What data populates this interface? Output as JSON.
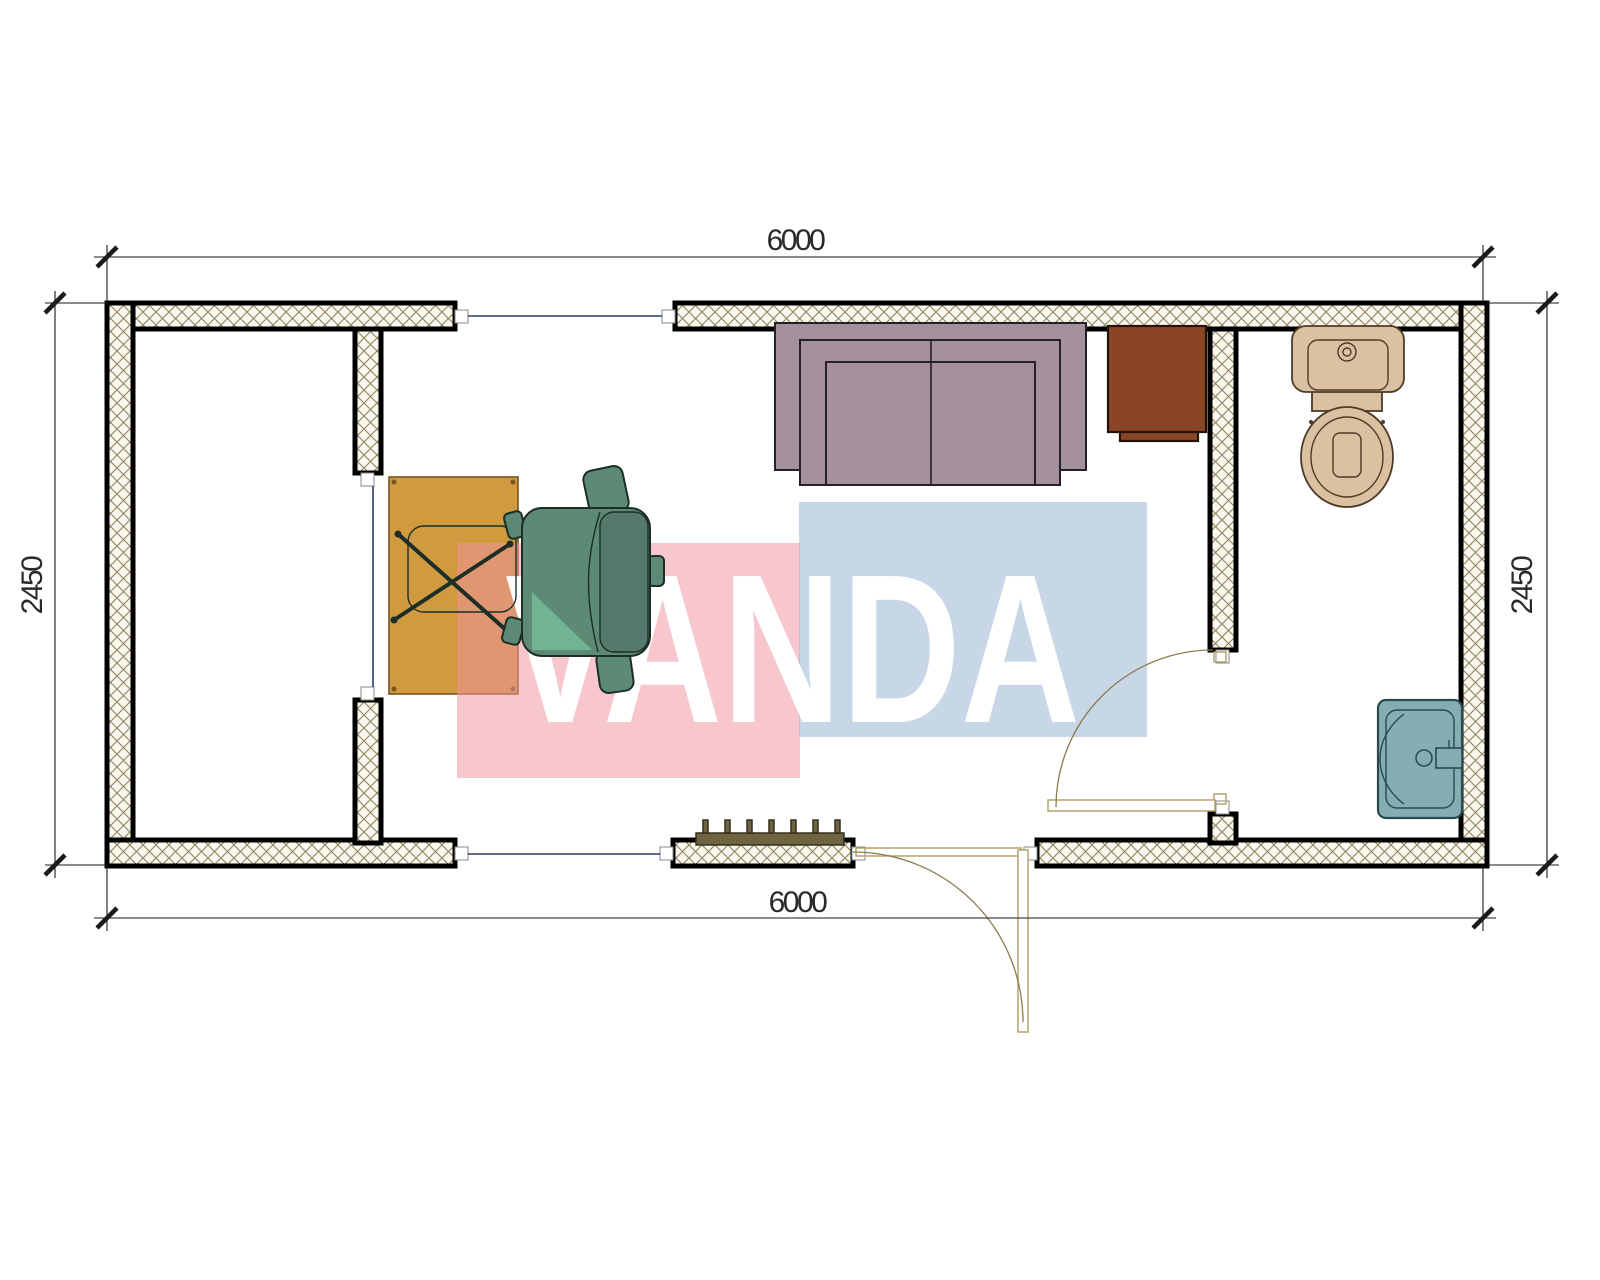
{
  "drawing": {
    "type": "floor-plan",
    "watermark": {
      "text": "VANDA"
    },
    "dimensions": {
      "top": "6000",
      "bottom": "6000",
      "left": "2450",
      "right": "2450"
    },
    "symbols": [
      "exterior-wall",
      "partition-wall",
      "window-opening",
      "door-swing",
      "desk",
      "office-chair",
      "sofa",
      "cabinet",
      "radiator",
      "toilet",
      "sink"
    ]
  },
  "colors": {
    "wall_edge": "#000000",
    "wall_hatch_line": "#8f835f",
    "wall_hatch_bg": "#faf7ee",
    "window_line": "#2b3a6b",
    "door_line": "#b49b62",
    "door_arc": "#8a7b4e",
    "dim_line": "#1a1a1a",
    "dim_text": "#2a2a2a",
    "desk": "#d09a3f",
    "desk_edge": "#7a5520",
    "chair": "#5d8a74",
    "chair_dark": "#55796b",
    "chair_light": "#72b391",
    "chair_lines": "#1c2e26",
    "sofa": "#a5909e",
    "sofa_edge": "#262028",
    "cabinet": "#8a4527",
    "cabinet_edge": "#241208",
    "toilet": "#dcc0a2",
    "toilet_edge": "#4d3b26",
    "sink": "#85adb4",
    "sink_edge": "#2c4850",
    "radiator": "#6e6444",
    "radiator_edge": "#36301c",
    "watermark_pink": "rgba(239,147,160,0.52)",
    "watermark_blue": "rgba(145,175,209,0.50)",
    "watermark_text": "#ffffff"
  }
}
